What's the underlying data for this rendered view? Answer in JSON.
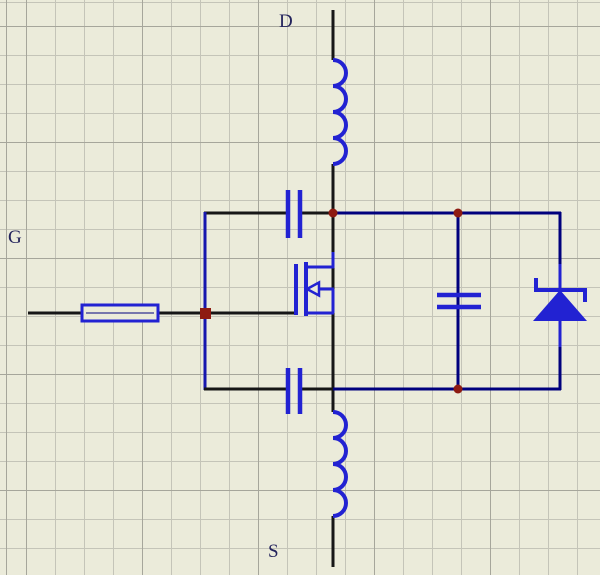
{
  "diagram": {
    "type": "circuit-schematic",
    "labels": [
      {
        "id": "drain",
        "text": "D"
      },
      {
        "id": "gate",
        "text": "G"
      },
      {
        "id": "source",
        "text": "S"
      }
    ],
    "palette": {
      "bg": "#ebebda",
      "grid_minor": "#c4c4b8",
      "grid_major": "#a6a69b",
      "black": "#161616",
      "navy": "#00007d",
      "rail": "#1616ae",
      "symbol": "#2222d2",
      "red": "#8e1b12",
      "label": "#23235c"
    },
    "shapes": [
      {
        "k": "line",
        "n": "wire-drain-pin",
        "c": "black",
        "p": [
          333,
          10,
          333,
          60
        ]
      },
      {
        "k": "line",
        "n": "wire-drain-to-junction",
        "c": "black",
        "p": [
          333,
          164,
          333,
          213
        ]
      },
      {
        "k": "line",
        "n": "wire-center-vertical",
        "c": "black",
        "p": [
          333,
          213,
          333,
          412
        ]
      },
      {
        "k": "line",
        "n": "wire-source-pin",
        "c": "black",
        "p": [
          333,
          516,
          333,
          567
        ]
      },
      {
        "k": "line",
        "n": "wire-top-left",
        "c": "black",
        "p": [
          204,
          213,
          287,
          213
        ]
      },
      {
        "k": "line",
        "n": "wire-top-mid",
        "c": "black",
        "p": [
          301,
          213,
          334,
          213
        ]
      },
      {
        "k": "line",
        "n": "wire-top-right",
        "c": "navy",
        "p": [
          333,
          213,
          561,
          213
        ]
      },
      {
        "k": "line",
        "n": "wire-left-rail",
        "c": "rail",
        "p": [
          205,
          212,
          205,
          390
        ]
      },
      {
        "k": "line",
        "n": "wire-gate",
        "c": "black",
        "p": [
          158,
          313,
          294,
          313
        ]
      },
      {
        "k": "line",
        "n": "wire-gate-input",
        "c": "black",
        "p": [
          28,
          313,
          82,
          313
        ]
      },
      {
        "k": "line",
        "n": "wire-bottom-left",
        "c": "black",
        "p": [
          204,
          389,
          287,
          389
        ]
      },
      {
        "k": "line",
        "n": "wire-bottom-mid",
        "c": "black",
        "p": [
          301,
          389,
          334,
          389
        ]
      },
      {
        "k": "line",
        "n": "wire-bottom-right",
        "c": "navy",
        "p": [
          333,
          389,
          561,
          389
        ]
      },
      {
        "k": "line",
        "n": "wire-cap-branch",
        "c": "navy",
        "p": [
          458,
          213,
          458,
          389
        ]
      },
      {
        "k": "line",
        "n": "wire-diode-branch-top",
        "c": "navy",
        "p": [
          560,
          212,
          560,
          279
        ]
      },
      {
        "k": "line",
        "n": "wire-diode-branch-bottom",
        "c": "navy",
        "p": [
          560,
          321,
          560,
          390
        ]
      },
      {
        "k": "rect",
        "n": "resistor-body",
        "c": "symbol",
        "f": "bg",
        "w": 3,
        "p": [
          82,
          305,
          76,
          16
        ]
      },
      {
        "k": "line",
        "n": "resistor-inner-line",
        "c": "navy",
        "w": 1,
        "p": [
          86,
          313,
          154,
          313
        ]
      },
      {
        "k": "path",
        "n": "inductor-top",
        "c": "symbol",
        "w": 4,
        "d": "M333,60 A13,13 0 0 1 333,86 A13,13 0 0 1 333,112 A13,13 0 0 1 333,138 A13,13 0 0 1 333,164"
      },
      {
        "k": "path",
        "n": "inductor-bottom",
        "c": "symbol",
        "w": 4,
        "d": "M333,412 A13,13 0 0 1 333,438 A13,13 0 0 1 333,464 A13,13 0 0 1 333,490 A13,13 0 0 1 333,516"
      },
      {
        "k": "line",
        "n": "capacitor-top-plate-left",
        "c": "symbol",
        "w": 4.5,
        "p": [
          288,
          190,
          288,
          238
        ]
      },
      {
        "k": "line",
        "n": "capacitor-top-plate-right",
        "c": "symbol",
        "w": 4.5,
        "p": [
          300,
          190,
          300,
          238
        ]
      },
      {
        "k": "line",
        "n": "capacitor-bottom-plate-left",
        "c": "symbol",
        "w": 4.5,
        "p": [
          288,
          368,
          288,
          414
        ]
      },
      {
        "k": "line",
        "n": "capacitor-bottom-plate-right",
        "c": "symbol",
        "w": 4.5,
        "p": [
          300,
          368,
          300,
          414
        ]
      },
      {
        "k": "line",
        "n": "capacitor-right-plate-top",
        "c": "symbol",
        "w": 4.5,
        "p": [
          437,
          295,
          481,
          295
        ]
      },
      {
        "k": "line",
        "n": "capacitor-right-plate-bottom",
        "c": "symbol",
        "w": 4.5,
        "p": [
          437,
          307,
          481,
          307
        ]
      },
      {
        "k": "line",
        "n": "mosfet-gate-bar",
        "c": "symbol",
        "w": 4,
        "p": [
          296,
          264,
          296,
          315
        ]
      },
      {
        "k": "line",
        "n": "mosfet-channel-bar",
        "c": "symbol",
        "w": 4,
        "p": [
          306,
          262,
          306,
          316
        ]
      },
      {
        "k": "line",
        "n": "mosfet-drain-lead",
        "c": "symbol",
        "w": 3,
        "p": [
          333,
          252,
          333,
          268
        ]
      },
      {
        "k": "line",
        "n": "mosfet-drain-stub",
        "c": "symbol",
        "w": 3,
        "p": [
          306,
          267,
          334,
          267
        ]
      },
      {
        "k": "line",
        "n": "mosfet-source-stub",
        "c": "symbol",
        "w": 3,
        "p": [
          306,
          313,
          334,
          313
        ]
      },
      {
        "k": "line",
        "n": "mosfet-bulk-stub",
        "c": "symbol",
        "w": 3,
        "p": [
          317,
          289,
          334,
          289
        ]
      },
      {
        "k": "line",
        "n": "mosfet-bulk-connector",
        "c": "symbol",
        "w": 3,
        "p": [
          333,
          289,
          333,
          313
        ]
      },
      {
        "k": "polygon",
        "n": "mosfet-arrow",
        "c": "symbol",
        "f": "bg",
        "w": 2.5,
        "pts": "307,289 319,282.5 319,295.5"
      },
      {
        "k": "line",
        "n": "diode-cathode-lead",
        "c": "symbol",
        "w": 3,
        "p": [
          560,
          264,
          560,
          290
        ]
      },
      {
        "k": "line",
        "n": "diode-anode-lead",
        "c": "symbol",
        "w": 3,
        "p": [
          560,
          321,
          560,
          347
        ]
      },
      {
        "k": "polygon",
        "n": "diode-triangle",
        "f": "symbol",
        "pts": "560,290 533,321 587,321"
      },
      {
        "k": "line",
        "n": "diode-cathode-bar",
        "c": "symbol",
        "w": 4,
        "p": [
          536,
          290,
          585,
          290
        ]
      },
      {
        "k": "line",
        "n": "diode-zener-tick-left",
        "c": "symbol",
        "w": 4,
        "p": [
          536,
          278,
          536,
          292
        ]
      },
      {
        "k": "line",
        "n": "diode-zener-tick-right",
        "c": "symbol",
        "w": 4,
        "p": [
          585,
          288,
          585,
          302
        ]
      },
      {
        "k": "circle",
        "n": "junction-dot-drain",
        "f": "red",
        "p": [
          333,
          213,
          4.5
        ]
      },
      {
        "k": "circle",
        "n": "junction-dot-cap-top",
        "f": "red",
        "p": [
          458,
          213,
          4.5
        ]
      },
      {
        "k": "circle",
        "n": "junction-dot-cap-bottom",
        "f": "red",
        "p": [
          458,
          389,
          4.5
        ]
      },
      {
        "k": "rect",
        "n": "junction-square-gate",
        "f": "red",
        "p": [
          200,
          308,
          11,
          11
        ]
      }
    ]
  }
}
